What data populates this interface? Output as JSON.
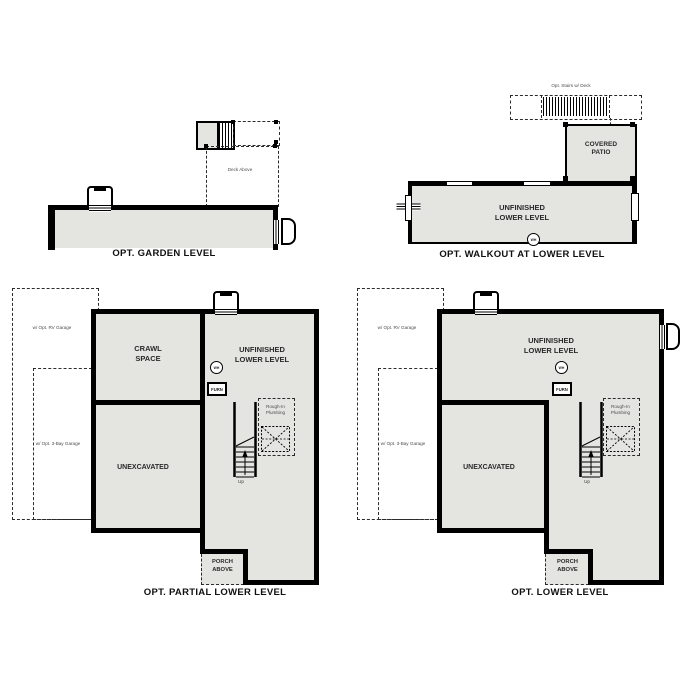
{
  "document": {
    "type": "floor-plan-options-sheet"
  },
  "colors": {
    "floor_fill": "#e4e4e1",
    "wall": "#000000",
    "background": "#ffffff"
  },
  "plans": {
    "garden": {
      "caption": "OPT. GARDEN LEVEL",
      "deck_label": "Deck Above"
    },
    "walkout": {
      "caption": "OPT. WALKOUT AT LOWER LEVEL",
      "stairs_label": "Opt. Stairs w/ Deck",
      "patio_label": "COVERED PATIO",
      "room_label": "UNFINISHED LOWER LEVEL",
      "wh_label": "WH"
    },
    "partial": {
      "caption": "OPT. PARTIAL LOWER LEVEL",
      "rv_garage_label": "w/ Opt. RV Garage",
      "bay_garage_label": "w/ Opt. 3-Bay Garage",
      "crawl_label": "CRAWL SPACE",
      "unexcavated_label": "UNEXCAVATED",
      "room_label": "UNFINISHED LOWER LEVEL",
      "wh_label": "WH",
      "furn_label": "FURN",
      "rough_in_label": "Rough-In Plumbing",
      "up_label": "Up",
      "porch_label": "PORCH ABOVE"
    },
    "lower": {
      "caption": "OPT. LOWER LEVEL",
      "rv_garage_label": "w/ Opt. RV Garage",
      "bay_garage_label": "w/ Opt. 3-Bay Garage",
      "unexcavated_label": "UNEXCAVATED",
      "room_label": "UNFINISHED LOWER LEVEL",
      "wh_label": "WH",
      "furn_label": "FURN",
      "rough_in_label": "Rough-In Plumbing",
      "up_label": "Up",
      "porch_label": "PORCH ABOVE"
    }
  }
}
